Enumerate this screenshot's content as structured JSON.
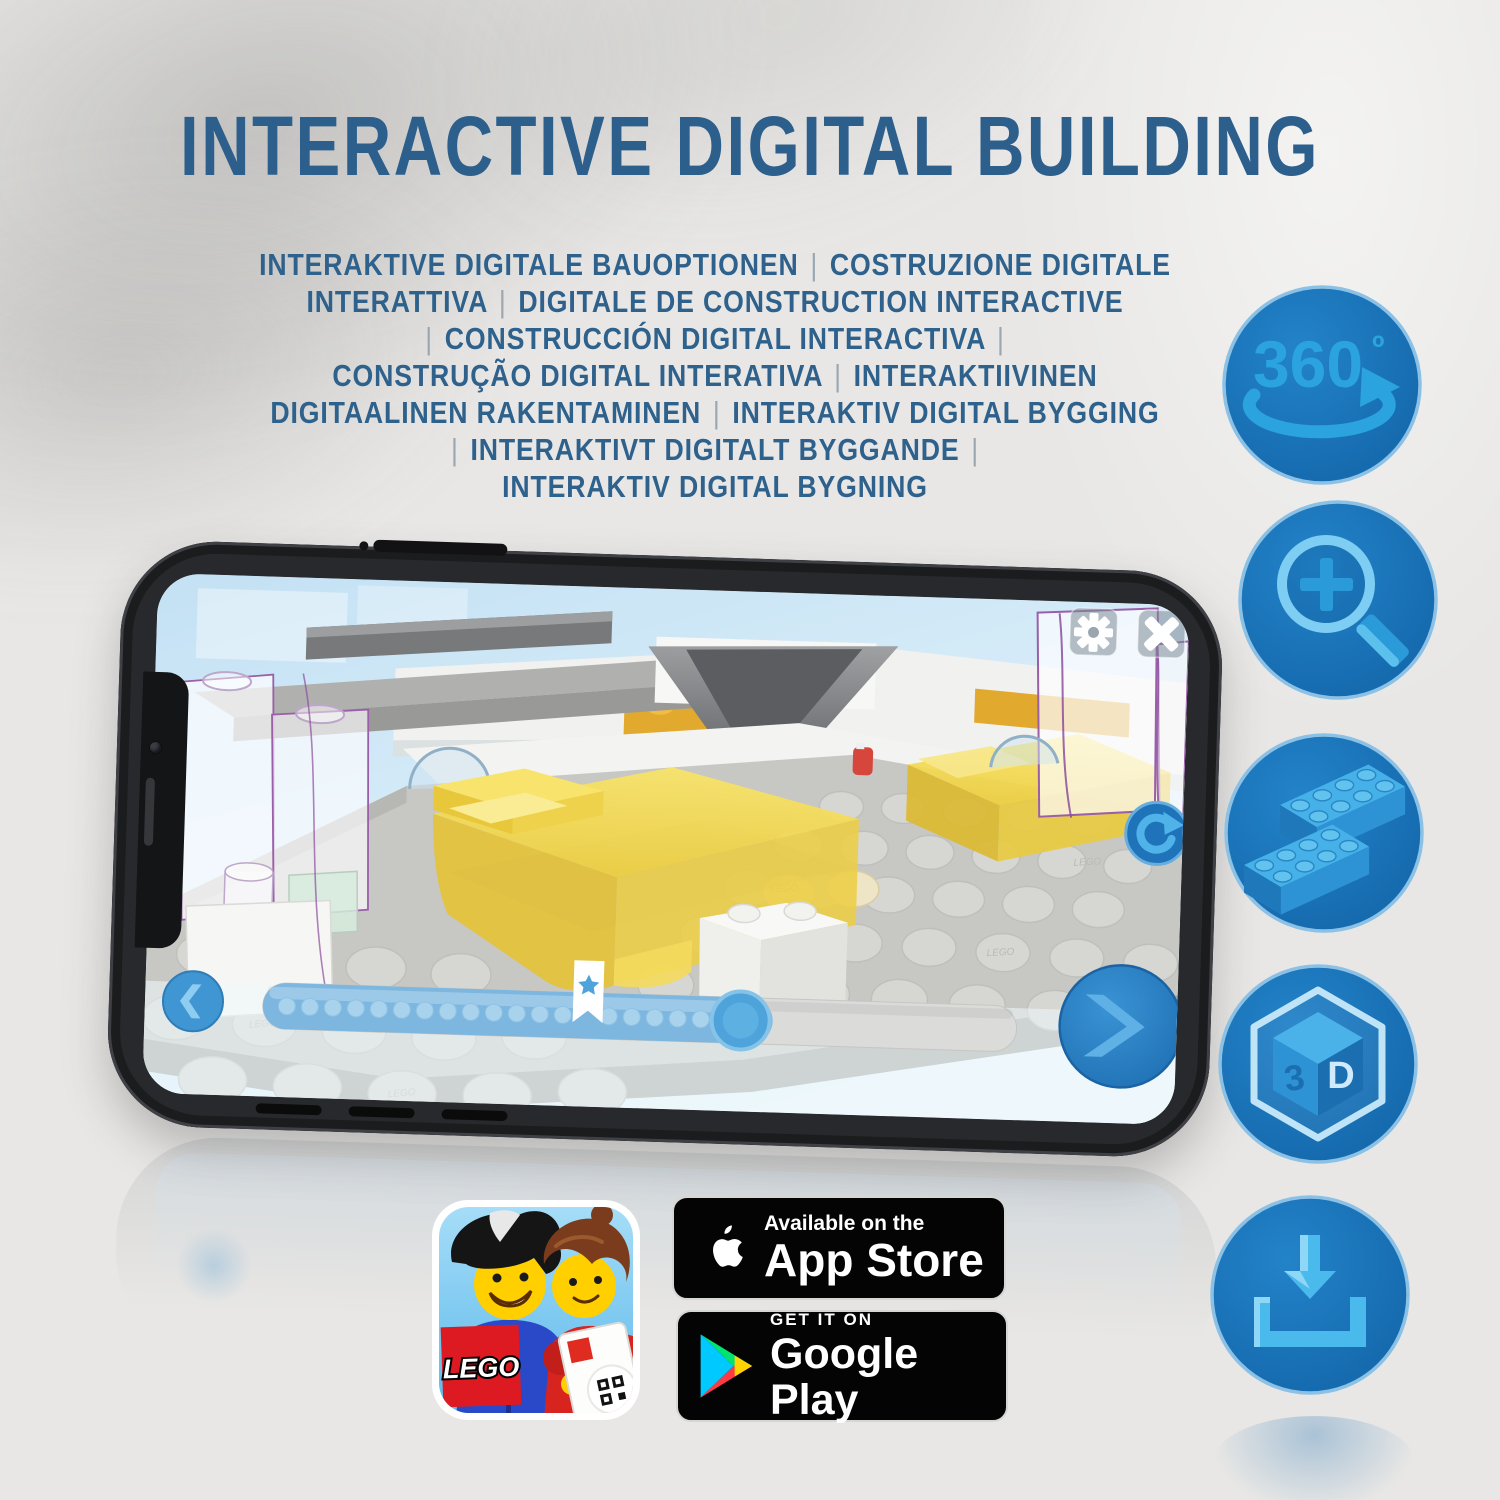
{
  "title": {
    "text": "INTERACTIVE DIGITAL BUILDING"
  },
  "subtitle": {
    "lines": [
      "INTERAKTIVE DIGITALE BAUOPTIONEN | COSTRUZIONE DIGITALE",
      "INTERATTIVA | DIGITALE DE CONSTRUCTION INTERACTIVE",
      "| CONSTRUCCIÓN DIGITAL INTERACTIVA |",
      "CONSTRUÇÃO DIGITAL INTERATIVA | INTERAKTIIVINEN",
      "DIGITAALINEN RAKENTAMINEN | INTERAKTIV DIGITAL BYGGING",
      "| INTERAKTIVT DIGITALT BYGGANDE |",
      "INTERAKTIV DIGITAL BYGNING"
    ]
  },
  "feature_icons": {
    "rotate360": {
      "label": "360",
      "degree": "º"
    },
    "threeD": {
      "left": "3",
      "right": "D"
    }
  },
  "app_ui": {
    "progress": {
      "star_percent": 41,
      "knob_percent": 63
    }
  },
  "store": {
    "lego_app": {
      "logo": "LEGO"
    },
    "app_store": {
      "line1": "Available on the",
      "line2": "App Store"
    },
    "google_play": {
      "line1": "GET IT ON",
      "line2": "Google Play"
    }
  },
  "colors": {
    "title_blue": "#2d5f8c",
    "circle_blue": "#1b75bc",
    "icon_art_blue": "#2aa3de",
    "lego_red": "#dd1a22",
    "badge_black": "#040404",
    "screen_sky": "#cfe7f6",
    "brick_yellow": "#f3d74f",
    "outline_purple": "#9a5fa8"
  }
}
